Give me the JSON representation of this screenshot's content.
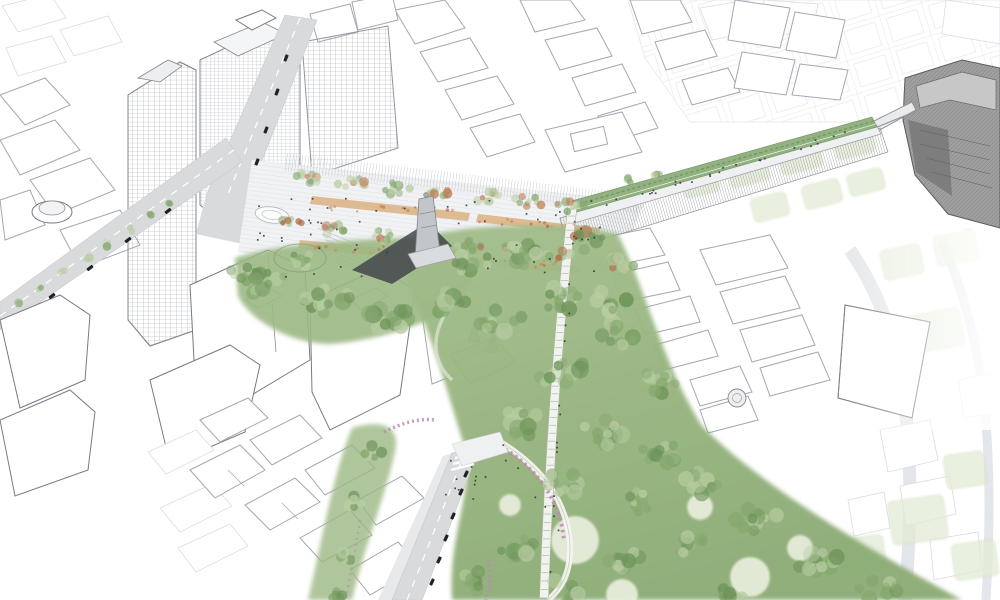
{
  "meta": {
    "description": "Aerial axonometric architectural rendering of an urban masterplan: a linear green park corridor cutting through a line-drawn city, with a striped plaza, monument, elevated planted walkway and a palace at the right edge"
  },
  "palette": {
    "background": "#ffffff",
    "line": "#a3a8b0",
    "line_faint": "#d9dce1",
    "line_dark": "#767b83",
    "road": "#d9dadc",
    "road_edge": "#c4c6ca",
    "paving": "#f1f2f4",
    "paving_stripe": "#e0e2e6",
    "trellis": "#c3c7cc",
    "bed_tan": "#dcb181",
    "bed_orange": "#c98a54",
    "green_base": "#9cb884",
    "green_mid": "#85a86e",
    "green_dark": "#6d9459",
    "green_light": "#b9cda3",
    "green_pale": "#d5e2c4",
    "tree_orange": "#c07e54",
    "tree_rust": "#b06b48",
    "clearing": "#e6ecda",
    "clearing_line": "#b6c4a0",
    "flower_pink": "#bb8cb4",
    "walkway_green": "#92b281",
    "wall": "#888c92",
    "palace": "#9f9f9f",
    "palace_dark": "#757575",
    "palace_light": "#c7c7c7",
    "parterre": "#e3ebd6",
    "parterre_line": "#ccd9b8",
    "path_white": "#f4f5f1",
    "path_edge": "#aab0a2",
    "car": "#202225",
    "people": "#2e3134",
    "monument": "#c2c6ca",
    "monument_shadow": "#43474c"
  },
  "scene": {
    "tree_palettes": [
      [
        "green_mid",
        "tree_orange",
        "green_light"
      ],
      [
        "green_mid",
        "tree_rust",
        "green_light"
      ],
      [
        "green_mid",
        "green_dark",
        "green_light"
      ],
      [
        "green_mid",
        "tree_rust",
        "green_dark"
      ],
      [
        "bed_orange",
        "tree_rust"
      ],
      [
        "green_mid",
        "green_light"
      ]
    ],
    "tree_clusters": [
      [
        310,
        176,
        16,
        7,
        9,
        2.5,
        5,
        0
      ],
      [
        352,
        182,
        16,
        7,
        9,
        2.5,
        5,
        0
      ],
      [
        396,
        188,
        16,
        7,
        9,
        2.5,
        5,
        0
      ],
      [
        440,
        193,
        16,
        7,
        9,
        2.5,
        5,
        0
      ],
      [
        484,
        197,
        16,
        7,
        9,
        2.5,
        5,
        0
      ],
      [
        528,
        201,
        16,
        7,
        9,
        2.5,
        5,
        0
      ],
      [
        570,
        206,
        14,
        6,
        8,
        2.5,
        5,
        0
      ],
      [
        292,
        224,
        14,
        6,
        8,
        2.5,
        5,
        1
      ],
      [
        336,
        230,
        14,
        6,
        8,
        2.5,
        5,
        1
      ],
      [
        380,
        236,
        14,
        6,
        8,
        2.5,
        5,
        1
      ],
      [
        468,
        246,
        14,
        6,
        8,
        2.5,
        5,
        1
      ],
      [
        515,
        250,
        14,
        6,
        8,
        2.5,
        5,
        1
      ],
      [
        558,
        254,
        12,
        5,
        7,
        2.5,
        5,
        1
      ],
      [
        268,
        284,
        22,
        14,
        12,
        4,
        9,
        2
      ],
      [
        330,
        302,
        26,
        16,
        13,
        4,
        9,
        2
      ],
      [
        392,
        316,
        24,
        15,
        12,
        4,
        9,
        2
      ],
      [
        448,
        302,
        20,
        13,
        10,
        4,
        9,
        2
      ],
      [
        300,
        262,
        16,
        10,
        8,
        3,
        7,
        2
      ],
      [
        240,
        272,
        12,
        8,
        7,
        3,
        6,
        2
      ],
      [
        472,
        262,
        18,
        12,
        10,
        4,
        8,
        2
      ],
      [
        525,
        255,
        16,
        11,
        9,
        4,
        8,
        2
      ],
      [
        588,
        240,
        16,
        10,
        9,
        3,
        7,
        3
      ],
      [
        622,
        262,
        14,
        10,
        8,
        3,
        7,
        1
      ],
      [
        612,
        300,
        16,
        11,
        9,
        4,
        8,
        2
      ],
      [
        560,
        300,
        22,
        14,
        11,
        4,
        9,
        2
      ],
      [
        502,
        322,
        22,
        14,
        11,
        4,
        9,
        2
      ],
      [
        620,
        335,
        20,
        13,
        10,
        4,
        9,
        2
      ],
      [
        658,
        382,
        20,
        13,
        10,
        4,
        9,
        2
      ],
      [
        562,
        372,
        24,
        15,
        12,
        4,
        9,
        2
      ],
      [
        520,
        424,
        22,
        14,
        11,
        4,
        9,
        2
      ],
      [
        602,
        432,
        22,
        14,
        11,
        4,
        9,
        2
      ],
      [
        660,
        452,
        18,
        12,
        10,
        4,
        8,
        2
      ],
      [
        700,
        482,
        20,
        13,
        10,
        4,
        8,
        2
      ],
      [
        756,
        520,
        22,
        14,
        11,
        4,
        9,
        2
      ],
      [
        818,
        558,
        24,
        15,
        12,
        4,
        9,
        2
      ],
      [
        878,
        588,
        20,
        12,
        9,
        4,
        8,
        2
      ],
      [
        560,
        484,
        20,
        13,
        10,
        4,
        8,
        2
      ],
      [
        520,
        545,
        22,
        14,
        11,
        4,
        9,
        2
      ],
      [
        562,
        592,
        20,
        12,
        9,
        4,
        8,
        2
      ],
      [
        622,
        560,
        18,
        12,
        9,
        4,
        8,
        2
      ],
      [
        642,
        502,
        16,
        11,
        8,
        3,
        7,
        2
      ],
      [
        690,
        545,
        16,
        11,
        8,
        3,
        7,
        2
      ],
      [
        730,
        595,
        16,
        10,
        8,
        3,
        7,
        2
      ],
      [
        475,
        580,
        16,
        11,
        8,
        3,
        7,
        2
      ],
      [
        372,
        452,
        10,
        7,
        6,
        3,
        6,
        2
      ],
      [
        356,
        502,
        9,
        6,
        5,
        3,
        6,
        2
      ],
      [
        346,
        558,
        9,
        6,
        5,
        3,
        6,
        2
      ],
      [
        334,
        595,
        9,
        6,
        5,
        3,
        6,
        2
      ],
      [
        20,
        303,
        4,
        3,
        2,
        3,
        4.5,
        5
      ],
      [
        42,
        288,
        4,
        3,
        2,
        3,
        4.5,
        5
      ],
      [
        64,
        273,
        4,
        3,
        2,
        3,
        4.5,
        5
      ],
      [
        86,
        258,
        4,
        3,
        2,
        3,
        4.5,
        5
      ],
      [
        108,
        244,
        4,
        3,
        2,
        3,
        4.5,
        5
      ],
      [
        130,
        230,
        4,
        3,
        2,
        3,
        4.5,
        5
      ],
      [
        152,
        216,
        4,
        3,
        2,
        3,
        4.5,
        5
      ],
      [
        172,
        204,
        4,
        3,
        2,
        3,
        4.5,
        5
      ],
      [
        630,
        180,
        6,
        4,
        3,
        3,
        5,
        5
      ],
      [
        655,
        172,
        6,
        4,
        3,
        3,
        5,
        5
      ],
      [
        390,
        209,
        70,
        4,
        14,
        1,
        2,
        4
      ],
      [
        525,
        223,
        55,
        4,
        11,
        1,
        2,
        4
      ],
      [
        365,
        249,
        55,
        4,
        11,
        1,
        2,
        4
      ],
      [
        522,
        264,
        45,
        4,
        9,
        1,
        2,
        4
      ]
    ],
    "parterres": [
      [
        700,
        182,
        36,
        26,
        -14
      ],
      [
        748,
        170,
        40,
        28,
        -14
      ],
      [
        800,
        157,
        42,
        28,
        -14
      ],
      [
        854,
        143,
        40,
        26,
        -14
      ],
      [
        770,
        207,
        36,
        24,
        -14
      ],
      [
        822,
        194,
        38,
        24,
        -14
      ],
      [
        866,
        182,
        36,
        22,
        -14
      ],
      [
        880,
        352,
        44,
        36,
        -10
      ],
      [
        938,
        330,
        48,
        38,
        -10
      ],
      [
        902,
        262,
        40,
        30,
        -12
      ],
      [
        956,
        248,
        42,
        30,
        -12
      ],
      [
        918,
        520,
        56,
        44,
        -8
      ],
      [
        862,
        556,
        46,
        38,
        -8
      ],
      [
        965,
        470,
        40,
        34,
        -8
      ],
      [
        975,
        560,
        44,
        36,
        -8
      ]
    ],
    "clearings": [
      [
        575,
        540,
        24
      ],
      [
        750,
        577,
        20
      ],
      [
        700,
        507,
        13
      ],
      [
        622,
        595,
        16
      ],
      [
        800,
        548,
        13
      ],
      [
        510,
        505,
        11
      ]
    ],
    "cars": [
      [
        286,
        58,
        -69
      ],
      [
        277,
        92,
        -69
      ],
      [
        266,
        130,
        -69
      ],
      [
        257,
        162,
        -69
      ],
      [
        52,
        296,
        -38
      ],
      [
        90,
        268,
        -38
      ],
      [
        128,
        240,
        -38
      ],
      [
        168,
        211,
        -38
      ],
      [
        466,
        474,
        -65
      ],
      [
        461,
        492,
        -65
      ],
      [
        453,
        516,
        -65
      ],
      [
        446,
        538,
        -65
      ],
      [
        439,
        560,
        -65
      ],
      [
        432,
        582,
        -65
      ]
    ],
    "people_zones": [
      [
        "r",
        282,
        194,
        318,
        82,
        40
      ],
      [
        "r",
        250,
        204,
        60,
        46,
        9
      ],
      [
        "r",
        440,
        457,
        48,
        42,
        12
      ],
      [
        "r",
        560,
        218,
        40,
        26,
        6
      ],
      [
        "l",
        584,
        209,
        866,
        128,
        26,
        3
      ],
      [
        "l",
        574,
        212,
        546,
        592,
        14,
        3
      ],
      [
        "l",
        500,
        445,
        566,
        540,
        6,
        4
      ]
    ],
    "straight_path": {
      "x0": 573,
      "y0": 202,
      "cx": 552,
      "cy": 380,
      "x1": 544,
      "y1": 598,
      "width": 9,
      "ticks": 52
    }
  }
}
